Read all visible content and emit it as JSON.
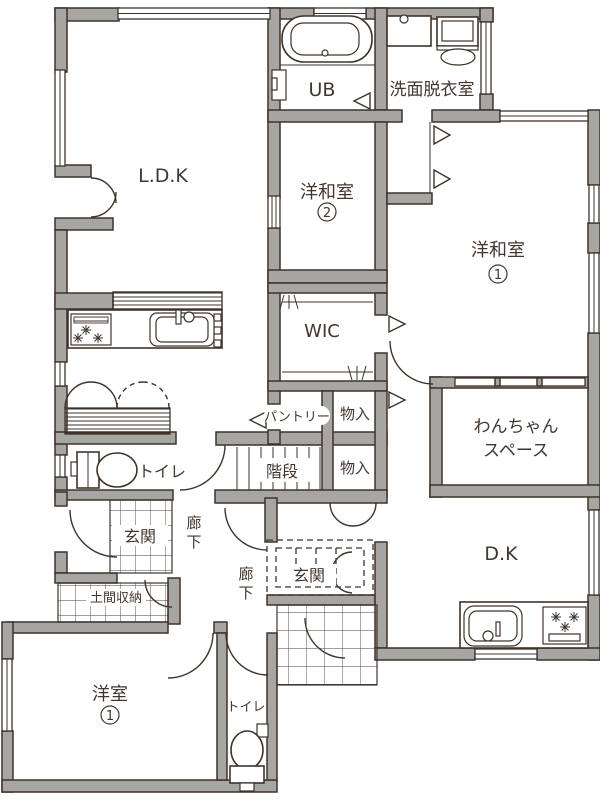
{
  "plan_type": "floor-plan",
  "colors": {
    "wall_fill": "#a7a6a2",
    "line": "#3e332b",
    "background": "#ffffff"
  },
  "labels": {
    "ldk": "L.D.K",
    "ub": "UB",
    "washroom": "洗面脱衣室",
    "jw_room2": "洋和室",
    "jw_room2_no": "2",
    "jw_room1": "洋和室",
    "jw_room1_no": "1",
    "wic": "WIC",
    "pantry": "パントリー",
    "storage_upper": "物入",
    "storage_lower": "物入",
    "dog_space_line1": "わんちゃん",
    "dog_space_line2": "スペース",
    "toilet_upper": "トイレ",
    "stairs": "階段",
    "entrance_main": "玄関",
    "hallway1_char1": "廊",
    "hallway1_char2": "下",
    "doma_storage": "土間収納",
    "hallway2_char1": "廊",
    "hallway2_char2": "下",
    "entrance_2": "玄関",
    "dk": "D.K",
    "western_room1": "洋室",
    "western_room1_no": "1",
    "toilet_lower": "トイレ"
  }
}
